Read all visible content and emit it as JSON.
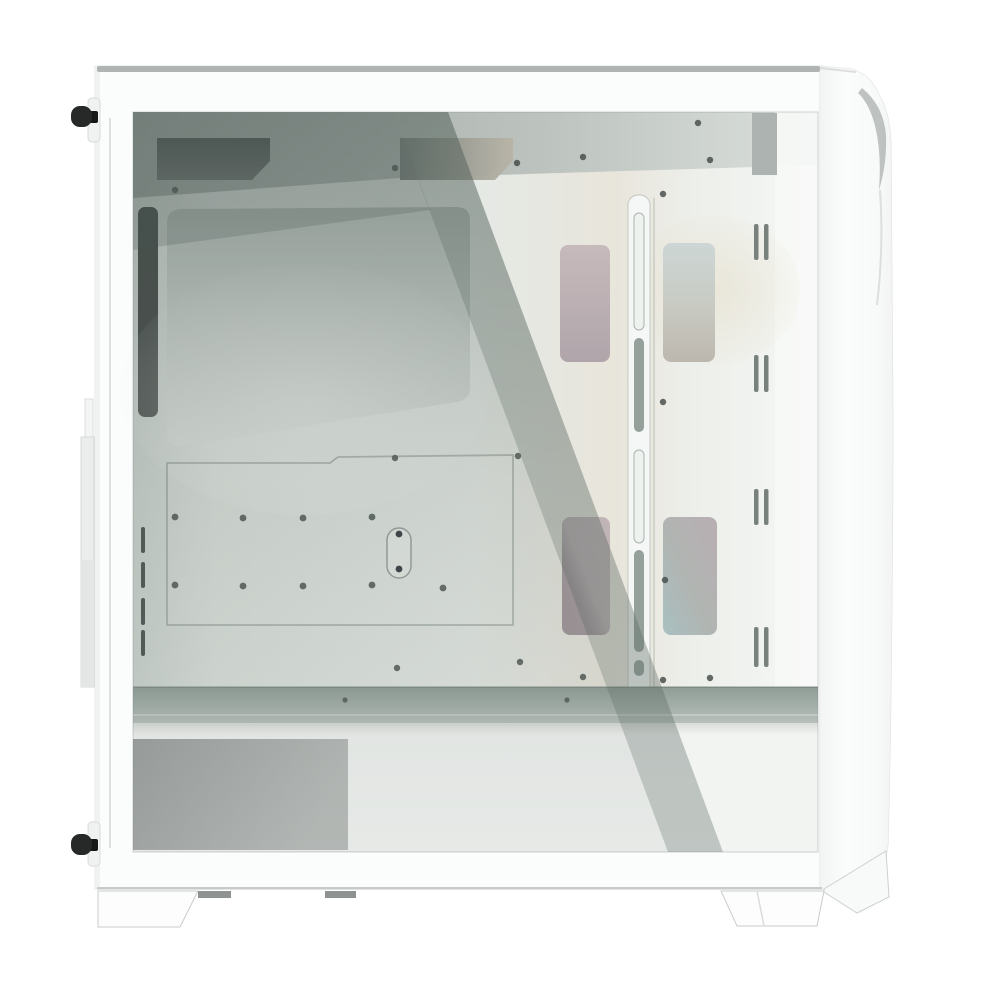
{
  "meta": {
    "domain": "Natural-Image",
    "subject": "White mid-tower PC case with tempered-glass side panel",
    "view": "left side profile product photo on seamless white background",
    "visible_text": "none"
  },
  "palette": {
    "background": "#ffffff",
    "frame_white": "#fbfcfc",
    "bezel_white": "#f6f7f7",
    "top_strip_gray": "#b0b4b3",
    "bottom_edge_gray": "#c2c5c4",
    "foot_outline": "#c9cccb",
    "under_tab_gray": "#8e9391",
    "thumbscrew_black": "#262928",
    "thumbscrew_stem": "#161818",
    "rail_gray": "#eaedec",
    "interior_base": "#e5e9e5",
    "interior_shadow_band": "#99a29e",
    "top_cutout_dark": "#4e5452",
    "rear_slot_dark": "#3e4442",
    "rear_tick_dark": "#4b5350",
    "screw_hole": "#49514e",
    "obround_screw": "#333a40",
    "vent_slot_gray": "#79817d",
    "grommet_mauve": "#bcb0b4",
    "grommet_cyan": "#ccd5d4",
    "cable_bar_white": "#f4f7f5",
    "cable_slot_dark": "#96a09b",
    "floor_gray": "#9aa59f",
    "shroud_white": "#f2f4f2",
    "shroud_panel_gray": "#a4a8a7",
    "front_block_gray": "#adb3b1",
    "accent_crease_gray": "#b7bbba",
    "reflection_tint": "#5a655f"
  },
  "inventory": {
    "thumbscrews": 2,
    "case_feet": 2,
    "under_tabs": 2,
    "top_cable_cutouts": 2,
    "cable_grommets": 4,
    "vent_slot_pairs": 4,
    "rear_vent_ticks": 4,
    "cpu_cutouts": 1,
    "cable_bar_slots": 6,
    "screw_holes": 26,
    "psu_shroud_panels": 1,
    "glass_reflection_bands": 2
  }
}
